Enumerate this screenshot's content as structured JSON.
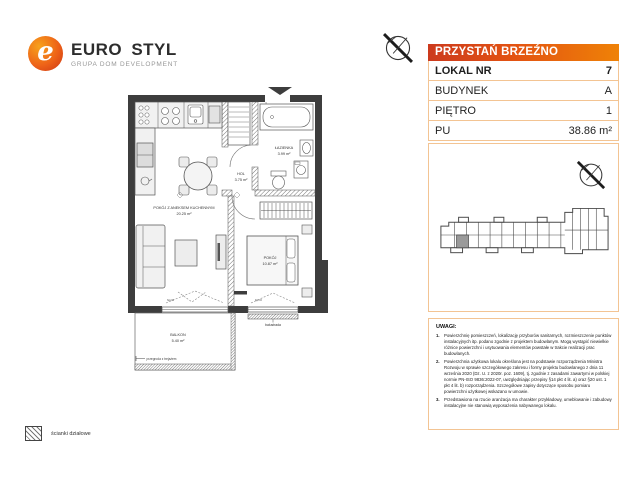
{
  "brand": {
    "name": "EURO STYL",
    "tagline": "GRUPA DOM DEVELOPMENT",
    "logo_letter": "e",
    "logo_color": "#ee6318"
  },
  "header": {
    "project": "PRZYSTAŃ BRZEŹNO",
    "accent_gradient": [
      "#cc3a1d",
      "#ef8207"
    ],
    "border_color": "#f3c493",
    "rows": [
      {
        "label": "LOKAL NR",
        "value": "7"
      },
      {
        "label": "BUDYNEK",
        "value": "A"
      },
      {
        "label": "PIĘTRO",
        "value": "1"
      },
      {
        "label": "PU",
        "value": "38.86 m²"
      }
    ]
  },
  "floor_plan": {
    "rooms": [
      {
        "name": "POKÓJ Z ANEKSEM KUCHENNYM",
        "area": "20.25 m²"
      },
      {
        "name": "POKÓJ",
        "area": "10.87 m²"
      },
      {
        "name": "ŁAZIENKA",
        "area": "3.99 m²"
      },
      {
        "name": "HOL",
        "area": "3.75 m²"
      },
      {
        "name": "BALKON",
        "area": "5.40 m²"
      }
    ],
    "annotations": {
      "balustrade": "balustrada",
      "partition_screen": "przegroda z trejażem",
      "sill_left": "hp=0",
      "sill_right": "hp=0"
    },
    "wall_color": "#3d3d3d"
  },
  "legend": {
    "partition_walls": "ścianki działowe"
  },
  "notes": {
    "title": "UWAGI:",
    "items": [
      {
        "num": "1.",
        "text": "Powierzchnię pomieszczeń, lokalizację przyborów sanitarnych, rozmieszczenie punktów instalacyjnych itp. podano zgodnie z projektem budowlanym. Mogą wystąpić niewielkie różnice powierzchni i usytuowania elementów powstałe w trakcie realizacji prac budowlanych."
      },
      {
        "num": "2.",
        "text": "Powierzchnia użytkowa lokalu określona jest na podstawie rozporządzenia Ministra Rozwoju w sprawie szczegółowego zakresu i formy projektu budowlanego z dnia 11 września 2020 (Dz. U. z 2020r. poz. 1609), tj. zgodnie z zasadami zawartymi w polskiej normie PN-ISO 9836:2022-07, uwzględniając przepisy §14 pkt 4 lit. a) oraz §20 ust. 1 pkt 4 lit. b) rozporządzenia. Szczegółowe zapisy dotyczące sposobu pomiaru powierzchni użytkowej wskazano w umowie."
      },
      {
        "num": "3.",
        "text": "Przedstawiona na rzucie aranżacja ma charakter przykładowy, umeblowanie i zabudowy instalacyjne nie stanowią wyposażenia nabywanego lokalu."
      }
    ]
  }
}
